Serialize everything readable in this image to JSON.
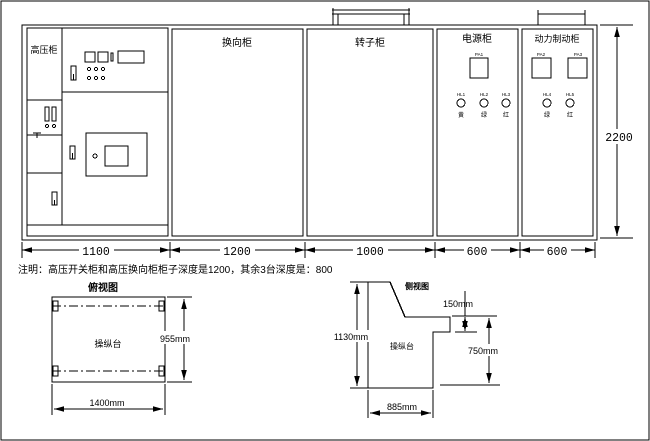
{
  "front_view": {
    "cabinet_labels": [
      "高压柜",
      "换向柜",
      "转子柜",
      "电源柜",
      "动力制动柜"
    ],
    "width_dims": [
      "1100",
      "1200",
      "1000",
      "600",
      "600"
    ],
    "height_dim": "2200",
    "power_cabinet": {
      "meter_tag": "PA1",
      "lamp_tags": [
        "HL1",
        "HL2",
        "HL3"
      ],
      "lamp_chars": [
        "黄",
        "绿",
        "红"
      ]
    },
    "brake_cabinet": {
      "meter_tags": [
        "PA2",
        "PA3"
      ],
      "lamp_tags": [
        "HL4",
        "HL5"
      ],
      "lamp_chars": [
        "绿",
        "红"
      ]
    }
  },
  "note": "注明：高压开关柜和高压换向柜柜子深度是1200，其余3台深度是：800",
  "top_view": {
    "title": "俯视图",
    "label": "操纵台",
    "width_dim": "1400mm",
    "depth_dim": "955mm"
  },
  "side_view": {
    "title": "侧视图",
    "label": "操纵台",
    "height_dim": "1130mm",
    "step_dim": "150mm",
    "front_height_dim": "750mm",
    "depth_dim": "885mm"
  }
}
